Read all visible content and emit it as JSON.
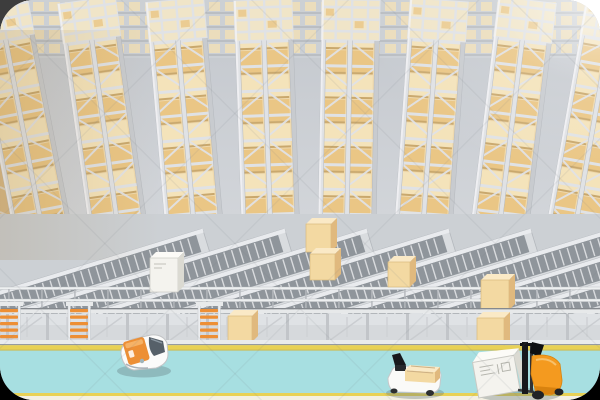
{
  "image": {
    "kind": "3d-render-illustration",
    "subject": "automated-warehouse-with-racks-conveyors-and-agvs"
  },
  "scene": {
    "racks": {
      "count": 8,
      "label": "high-bay-storage-rack-towers-filled-with-tan-cartons"
    },
    "conveyor_lanes": {
      "count": 9,
      "label": "roller-conveyor-lines"
    },
    "guard_rails": {
      "count": 3,
      "label": "horizontal-guard-rails"
    },
    "ladders": {
      "count": 3,
      "label": "orange-step-ladders"
    },
    "boxes": {
      "tan_on_conveyors": 4,
      "tan_under_platform": 2,
      "white_on_conveyor": 1
    },
    "vehicles": [
      {
        "name": "agv-robot",
        "label": "white-agv-shuttle-with-orange-lid"
      },
      {
        "name": "agv-cart",
        "label": "white-agv-cart-carrying-carton"
      },
      {
        "name": "forklift",
        "label": "orange-forklift-carrying-white-crate"
      }
    ],
    "floor": {
      "label": "cyan-floor-with-yellow-lane-stripes"
    }
  },
  "colors": {
    "corner_tl": "#3d3d3d",
    "corner_tr": "#ffffff",
    "corner_bottom": "#000000",
    "aisle_top": "#c3c7cd",
    "aisle_bottom": "#d5d8dc",
    "rack_steel": "#e0e2e5",
    "rack_steel_dark": "#b4b8bd",
    "rack_box_tan": "#eac685",
    "rack_box_light": "#f4e3ba",
    "rack_box_mid": "#efd9ad",
    "rack_box_deep": "#d9b478",
    "rack_box_shadowline": "#c9a86d",
    "rack_top_cream": "#f0e5c8",
    "conveyor_frame": "#d9dcdf",
    "conveyor_belt": "#8f959b",
    "conveyor_roller": "#e6e8ea",
    "leg": "#c2c5c9",
    "rail_light": "#eef0f1",
    "rail_dark": "#85898e",
    "deck": "#d6d9dc",
    "deck_light": "#dfe2e5",
    "yellow": "#e8d155",
    "yellow_dark": "#cdb73e",
    "floor_cyan": "#a7dfe1",
    "floor_cream": "#f4f0e2",
    "box_tan": "#f3d9a2",
    "box_tan_top": "#fae9c6",
    "box_tan_side": "#e0b97e",
    "box_white": "#f4f3ee",
    "box_white_top": "#fcfbf7",
    "box_white_side": "#dbdad2",
    "agv_orange": "#ed8f35",
    "agv_orange_light": "#f6b266",
    "forklift_orange": "#f49a1f",
    "forklift_orange_dark": "#d8820f",
    "dark_part": "#17181c",
    "window_gray": "#566069",
    "vehicle_shadow": "rgba(96,118,124,0.35)"
  }
}
